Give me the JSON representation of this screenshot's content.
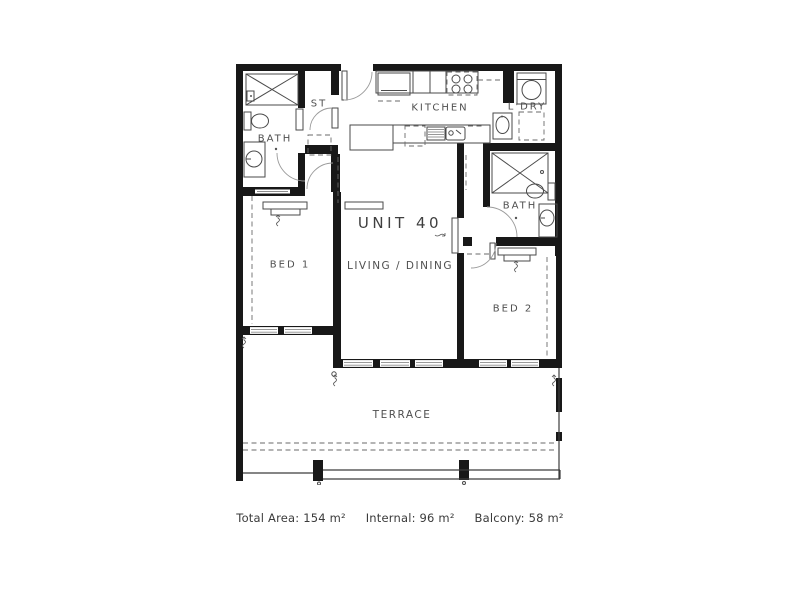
{
  "plan": {
    "unit_label": "UNIT 40",
    "rooms": {
      "bath1": {
        "label": "BATH"
      },
      "storage": {
        "label": "ST"
      },
      "kitchen": {
        "label": "KITCHEN"
      },
      "laundry": {
        "label": "L'DRY"
      },
      "bath2": {
        "label": "BATH"
      },
      "bed1": {
        "label": "BED 1"
      },
      "living": {
        "label": "LIVING / DINING"
      },
      "bed2": {
        "label": "BED 2"
      },
      "terrace": {
        "label": "TERRACE"
      }
    }
  },
  "caption": {
    "total_area": "Total Area: 154 m²",
    "internal": "Internal: 96 m²",
    "balcony": "Balcony: 58 m²"
  },
  "colors": {
    "wall": "#181818",
    "fixture_line": "#4a4a4a",
    "label_text": "#4f4f4f",
    "background": "#ffffff"
  },
  "icons": [
    "shower-icon",
    "toilet-icon",
    "basin-icon",
    "fridge-icon",
    "cooktop-icon",
    "kitchen-sink-icon",
    "dishwasher-icon",
    "washing-machine-icon",
    "laundry-tub-icon",
    "dryer-icon",
    "wardrobe-icon",
    "door-swing-icon",
    "window-icon",
    "balustrade-icon"
  ]
}
